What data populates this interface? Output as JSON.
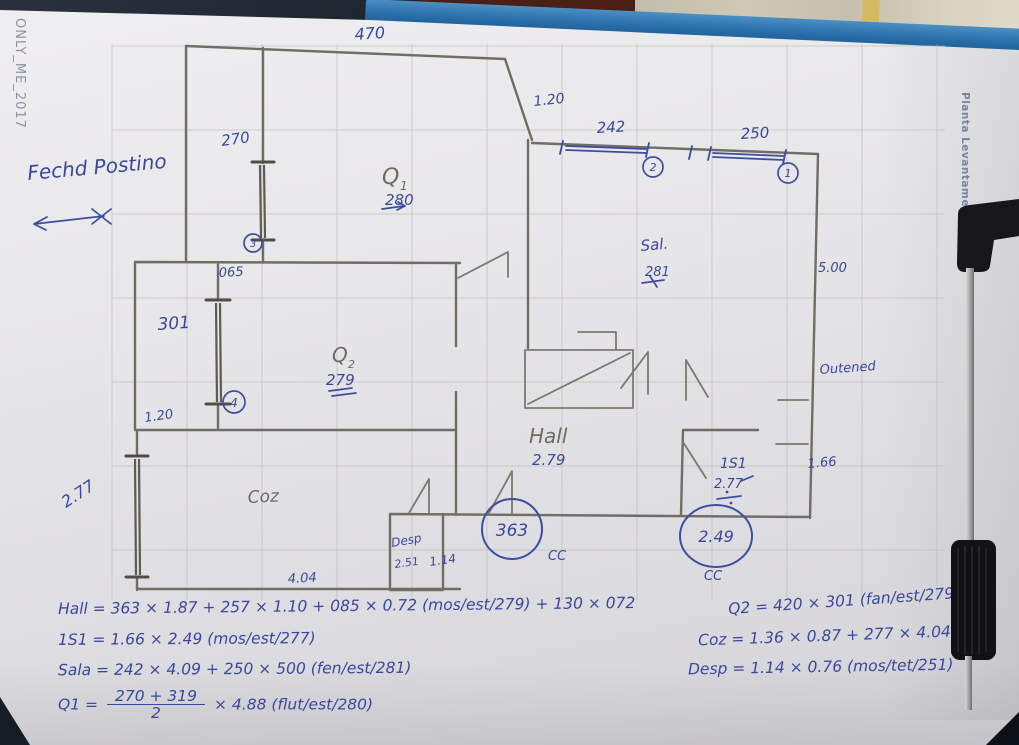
{
  "photo": {
    "background": "#141b24",
    "clipboard_blue": "#2e74ae",
    "paper": "#e7e6e9",
    "wall_beige": "#cfc9b6",
    "wall_strip_yellow": "#d4ba62",
    "wood_brown": "#4a2016",
    "pencil": "#6e6b60",
    "ink_blue": "#3a489c"
  },
  "watermarks": {
    "left": "ONLY_ME_2017",
    "right": "Planta Levantamento"
  },
  "notes": {
    "top_left": "Fechd Postino",
    "right_mid": "Outened"
  },
  "labels": {
    "top_width": "470",
    "q1_window": "270",
    "ref3": "3",
    "gap": "065",
    "q2_window": "301",
    "ref4": "4",
    "door_left": "1.20",
    "coz_window": "2.77",
    "top_opening": "1.20",
    "window2": "242",
    "ref2": "2",
    "window1": "250",
    "ref1": "1",
    "q1_name": "Q",
    "q1_sub": "1",
    "q1_area": "280",
    "q2_name": "Q",
    "q2_sub": "2",
    "q2_area": "279",
    "sala_name": "Sal.",
    "sala_area": "281",
    "sala_width": "5.00",
    "hall_name": "Hall",
    "hall_area": "2.79",
    "is1_name": "1S1",
    "is1_height": "2.77",
    "is1_width": "1.66",
    "cc_left_value": "363",
    "cc_left_label": "CC",
    "cc_right_value": "2.49",
    "cc_right_label": "CC",
    "desp_name": "Desp",
    "desp_height": "2.51",
    "desp_width": "1.14",
    "coz_name": "Coz",
    "coz_length": "4.04"
  },
  "formulas": {
    "hall": "Hall = 363 × 1.87 + 257 × 1.10 + 085 × 0.72 (mos/est/279) + 130 × 072",
    "is1": "1S1 = 1.66 × 2.49 (mos/est/277)",
    "sala": "Sala = 242 × 4.09 + 250 × 500 (fen/est/281)",
    "q1_prefix": "Q1 =",
    "q1_num": "270 + 319",
    "q1_den": "2",
    "q1_suffix": "× 4.88 (flut/est/280)",
    "q2": "Q2 = 420 × 301 (fan/est/279)",
    "coz": "Coz = 1.36 × 0.87 + 277 × 4.04",
    "desp": "Desp = 1.14 × 0.76 (mos/tet/251)"
  }
}
